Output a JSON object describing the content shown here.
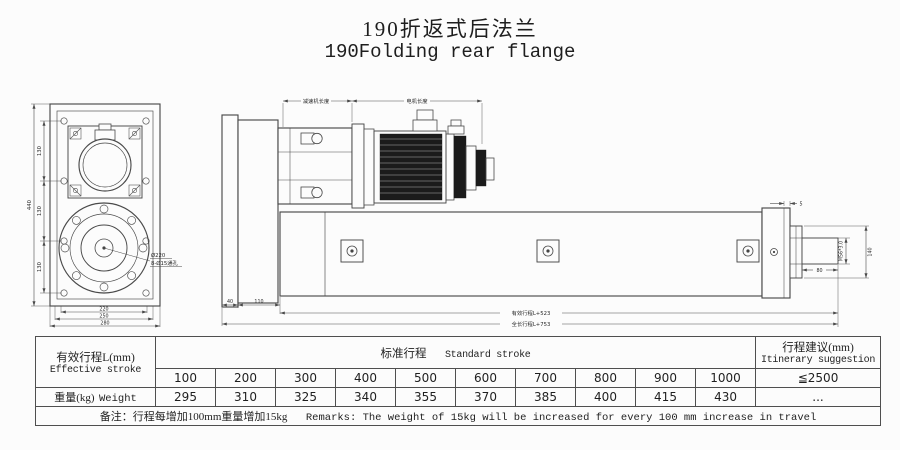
{
  "title": {
    "zh": "190折返式后法兰",
    "en": "190Folding rear flange"
  },
  "drawing": {
    "front": {
      "dim_130": "130",
      "dim_440": "440",
      "dim_220": "220",
      "dim_250": "250",
      "dim_280": "280",
      "label_bolt_circle": "Ø220",
      "label_holes": "8-Ø15通孔"
    },
    "side": {
      "label_reducer_length": "减速机长度",
      "label_motor_length": "电机长度",
      "dim_40": "40",
      "dim_110": "110",
      "dim_effective": "有效行程L+523",
      "dim_overall": "全长行程L+753",
      "dim_5": "5",
      "dim_140": "140",
      "dim_thread": "M56*3.0",
      "dim_80": "80"
    }
  },
  "table": {
    "stroke_header_zh": "有效行程L(mm)",
    "stroke_header_en": "Effective stroke",
    "standard_zh": "标准行程",
    "standard_en": "Standard stroke",
    "suggest_zh": "行程建议(mm)",
    "suggest_en": "Itinerary suggestion",
    "strokes": [
      "100",
      "200",
      "300",
      "400",
      "500",
      "600",
      "700",
      "800",
      "900",
      "1000"
    ],
    "suggest_max": "≦2500",
    "weight_zh": "重量(kg)",
    "weight_en": "Weight",
    "weights": [
      "295",
      "310",
      "325",
      "340",
      "355",
      "370",
      "385",
      "400",
      "415",
      "430"
    ],
    "weight_suggest": "...",
    "remark_zh": "备注：行程每增加100mm重量增加15kg",
    "remark_en": "Remarks: The weight of 15kg will be increased for every 100 mm increase in travel"
  }
}
